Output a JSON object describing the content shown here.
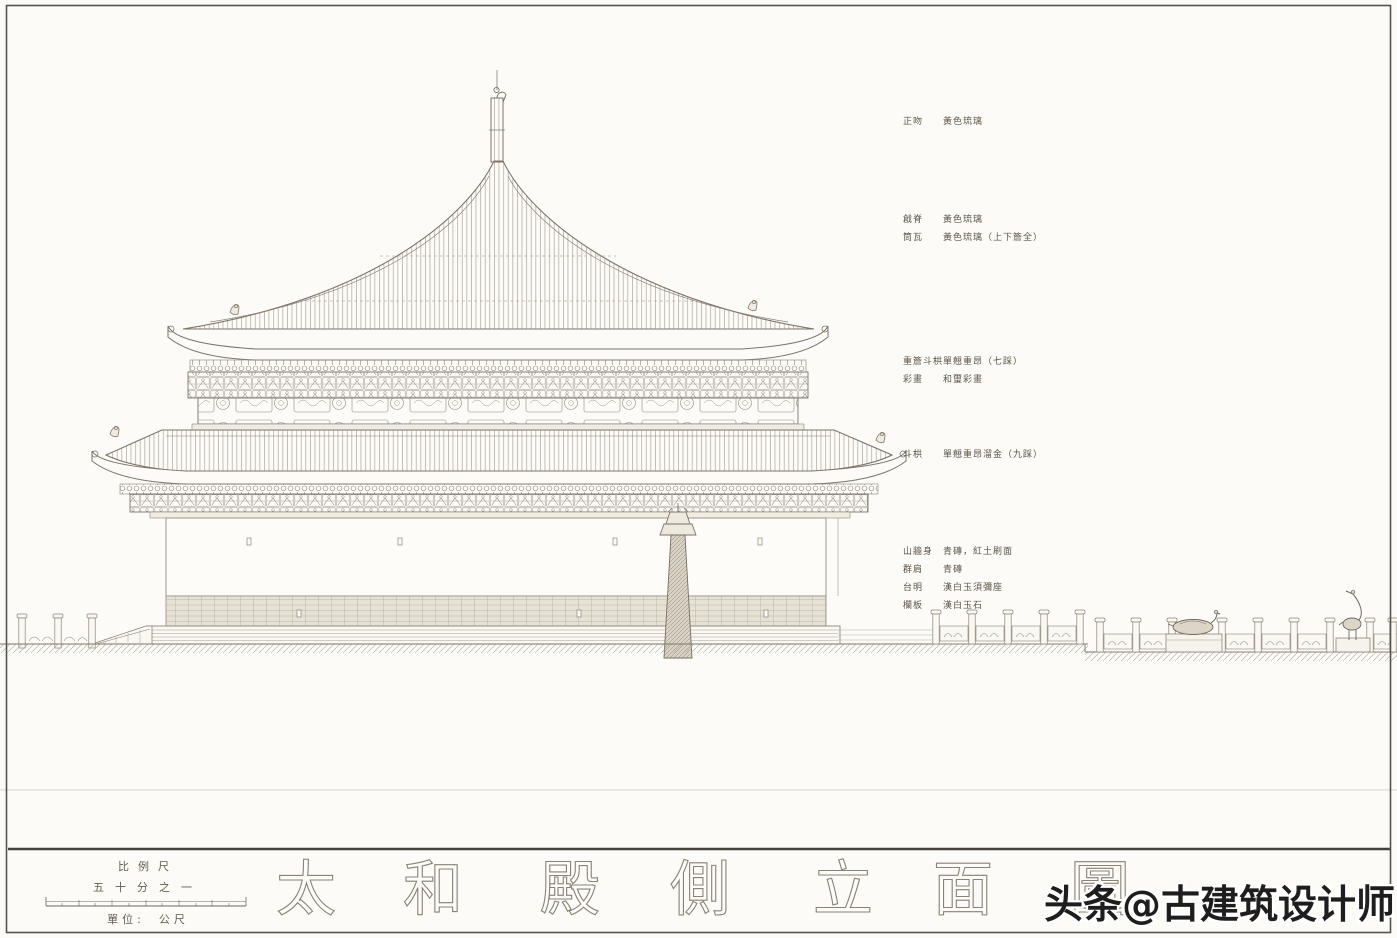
{
  "page": {
    "background_color": "#fcfbf7",
    "frame_color": "#56524c"
  },
  "drawing": {
    "subject": "太和殿 側立面圖 (side elevation line drawing of the Hall of Supreme Harmony)",
    "line_color": "#8a8276",
    "title_characters": [
      "太",
      "和",
      "殿",
      "側",
      "立",
      "面",
      "圖"
    ]
  },
  "annotations": {
    "groups": [
      {
        "items": [
          {
            "label": "正吻",
            "value": "黃色琉璃"
          }
        ]
      },
      {
        "items": [
          {
            "label": "戧脊",
            "value": "黃色琉璃"
          },
          {
            "label": "筒瓦",
            "value": "黃色琉璃（上下簷全）"
          }
        ]
      },
      {
        "items": [
          {
            "label": "重簷斗栱",
            "value": "單翹重昂（七踩）"
          },
          {
            "label": "彩畫",
            "value": "和璽彩畫"
          }
        ]
      },
      {
        "items": [
          {
            "label": "斗栱",
            "value": "單翹重昂溜金（九踩）"
          }
        ]
      },
      {
        "items": [
          {
            "label": "山牆身",
            "value": "青磚，紅土刷面"
          },
          {
            "label": "群肩",
            "value": "青磚"
          },
          {
            "label": "台明",
            "value": "漢白玉須彌座"
          },
          {
            "label": "欄板",
            "value": "漢白玉石"
          }
        ]
      }
    ]
  },
  "scale_block": {
    "title": "比例尺",
    "ratio": "五十分之一",
    "unit_label": "單位:",
    "unit_value": "公尺"
  },
  "watermark": {
    "text": "头条@古建筑设计师"
  }
}
